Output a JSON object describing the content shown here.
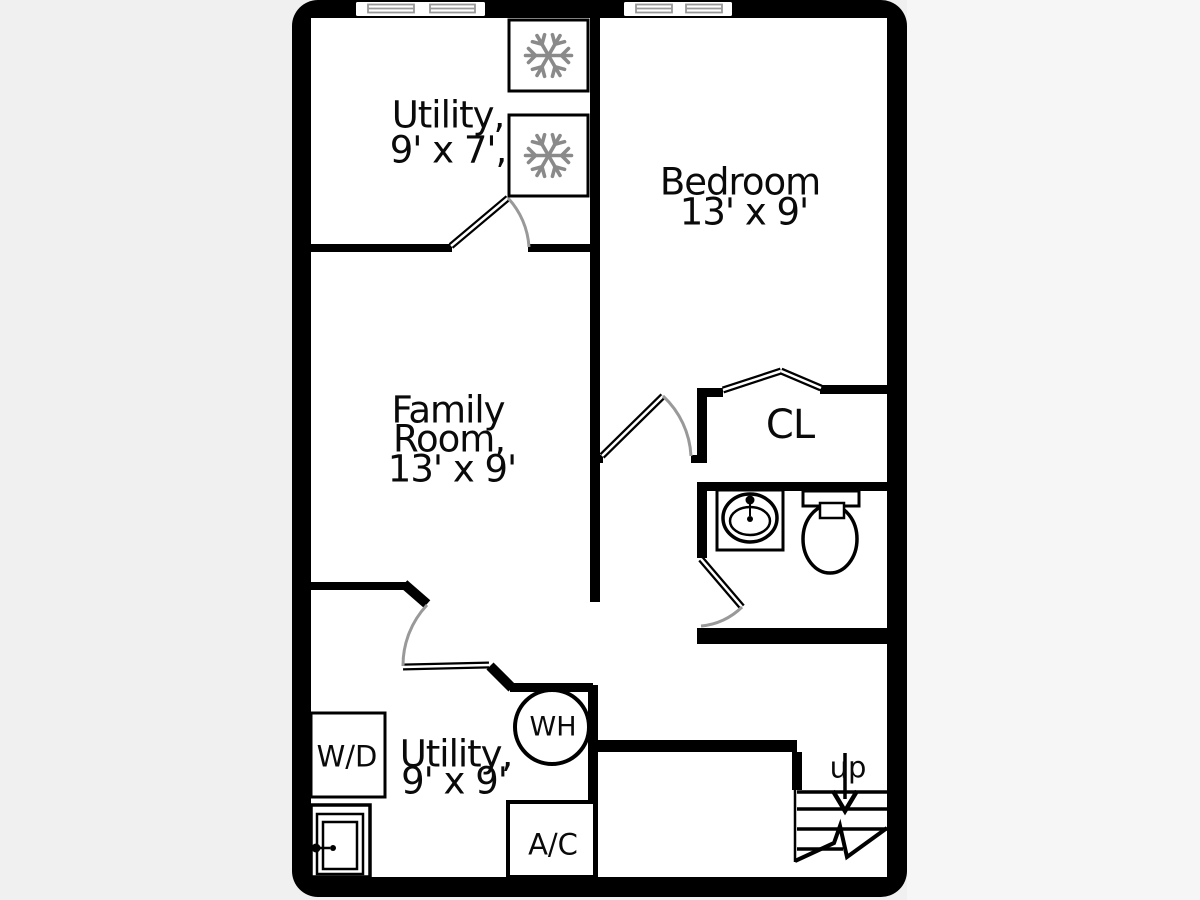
{
  "rooms": {
    "utility_top": {
      "name": "Utility,",
      "dims": "9' x 7',"
    },
    "bedroom": {
      "name": "Bedroom",
      "dims": "13' x 9'"
    },
    "family": {
      "line1": "Family",
      "line2": "Room,",
      "dims": "13' x 9'"
    },
    "closet": {
      "name": "CL"
    },
    "utility_bottom": {
      "name": "Utility,",
      "dims": "9' x 9'"
    }
  },
  "fixtures": {
    "washer_dryer": "W/D",
    "water_heater": "WH",
    "air_conditioner": "A/C",
    "stairs_direction": "up"
  },
  "icons": {
    "freezer": "snowflake-icon",
    "sink": "sink-icon",
    "toilet": "toilet-icon",
    "laundry_tub": "laundry-tub-icon",
    "stairs": "stairs-icon",
    "door": "door-swing-icon",
    "window": "window-icon"
  },
  "colors": {
    "wall": "#000000",
    "interior": "#ffffff",
    "background_left": "#f0f0f0",
    "background_right": "#f6f6f6",
    "door_arc": "#999999",
    "snowflake": "#8a8a8a",
    "window_glass": "#999999"
  }
}
